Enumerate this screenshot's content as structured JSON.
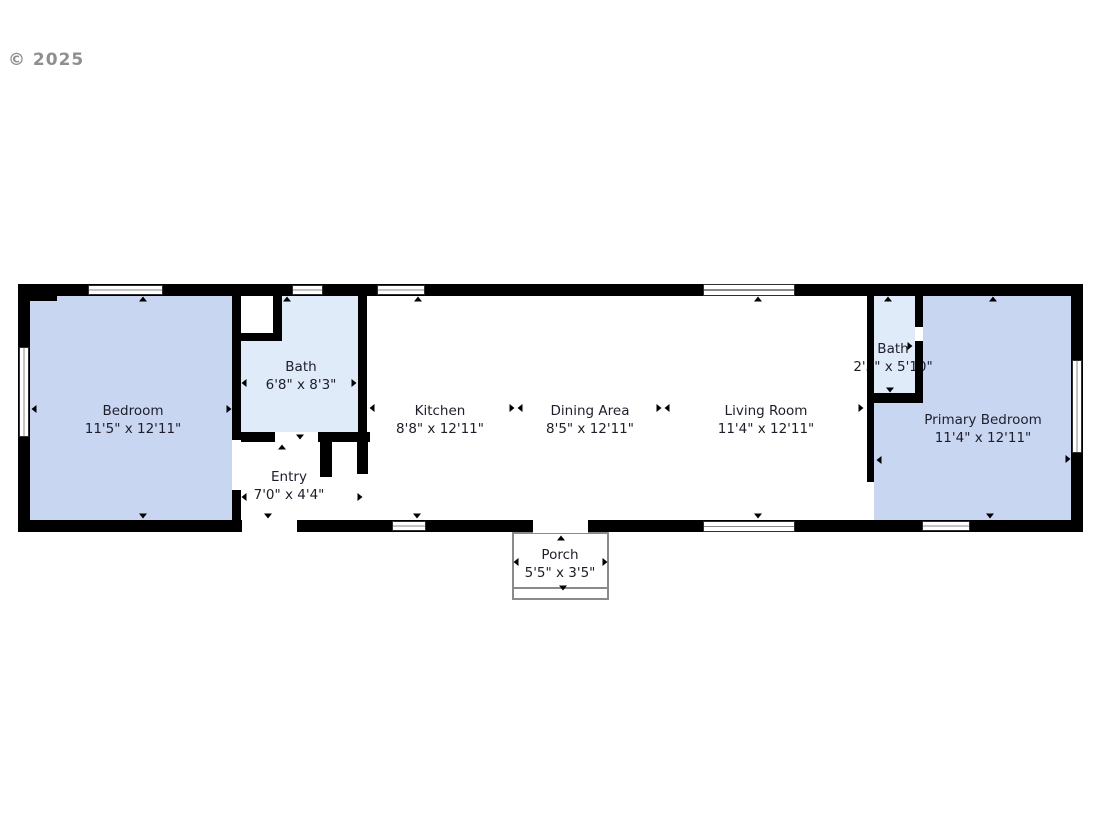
{
  "watermark": {
    "text": "© 2025"
  },
  "colors": {
    "wall": "#000000",
    "bedroom_fill": "#c9d6f2",
    "bath_fill": "#e0ebfa",
    "label_text": "#1e1e2a",
    "watermark_text": "#8f8f8f",
    "porch_border": "#8a8a8a"
  },
  "rooms": [
    {
      "id": "bedroom",
      "name": "Bedroom",
      "dims": "11'5\" x 12'11\""
    },
    {
      "id": "bath-1",
      "name": "Bath",
      "dims": "6'8\" x 8'3\""
    },
    {
      "id": "entry",
      "name": "Entry",
      "dims": "7'0\" x 4'4\""
    },
    {
      "id": "kitchen",
      "name": "Kitchen",
      "dims": "8'8\" x 12'11\""
    },
    {
      "id": "dining-area",
      "name": "Dining Area",
      "dims": "8'5\" x 12'11\""
    },
    {
      "id": "living-room",
      "name": "Living Room",
      "dims": "11'4\" x 12'11\""
    },
    {
      "id": "bath-2",
      "name": "Bath",
      "dims": "2'5\" x 5'10\""
    },
    {
      "id": "primary-bedroom",
      "name": "Primary Bedroom",
      "dims": "11'4\" x 12'11\""
    },
    {
      "id": "porch",
      "name": "Porch",
      "dims": "5'5\" x 3'5\""
    }
  ]
}
